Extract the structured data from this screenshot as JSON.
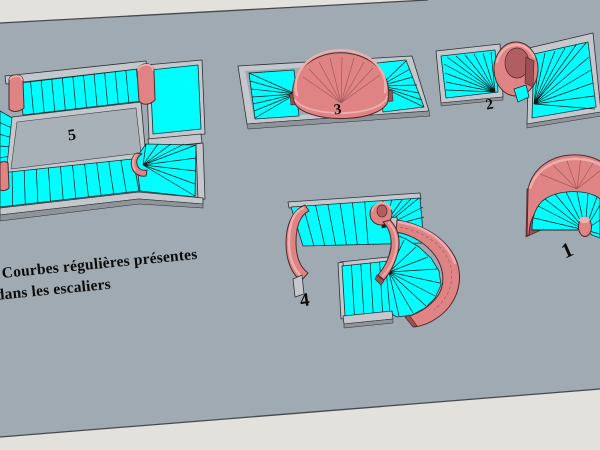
{
  "caption": {
    "line1": "Courbes régulières présentes",
    "line2": "dans les escaliers"
  },
  "stairs": [
    {
      "id": "stair-1",
      "label": "1"
    },
    {
      "id": "stair-2",
      "label": "2"
    },
    {
      "id": "stair-3",
      "label": "3"
    },
    {
      "id": "stair-4",
      "label": "4"
    },
    {
      "id": "stair-5",
      "label": "5"
    }
  ],
  "palette": {
    "background": "#e3e1db",
    "ground_plane": "#a0aab2",
    "plane_edge": "#45494e",
    "void_fill": "#a8b1b8",
    "tread_top": "#00feff",
    "tread_line": "#14181b",
    "stringer_top": "#c4c8cc",
    "stringer_side": "#8e9499",
    "stringer_outline": "#2c2f33",
    "wall_face": "#e08384",
    "wall_rim": "#efaeae",
    "wall_shadow": "#b05e61",
    "wall_deep": "#9a5153",
    "wall_outline": "#4e2b2c",
    "label_color": "#0b0b0b"
  }
}
